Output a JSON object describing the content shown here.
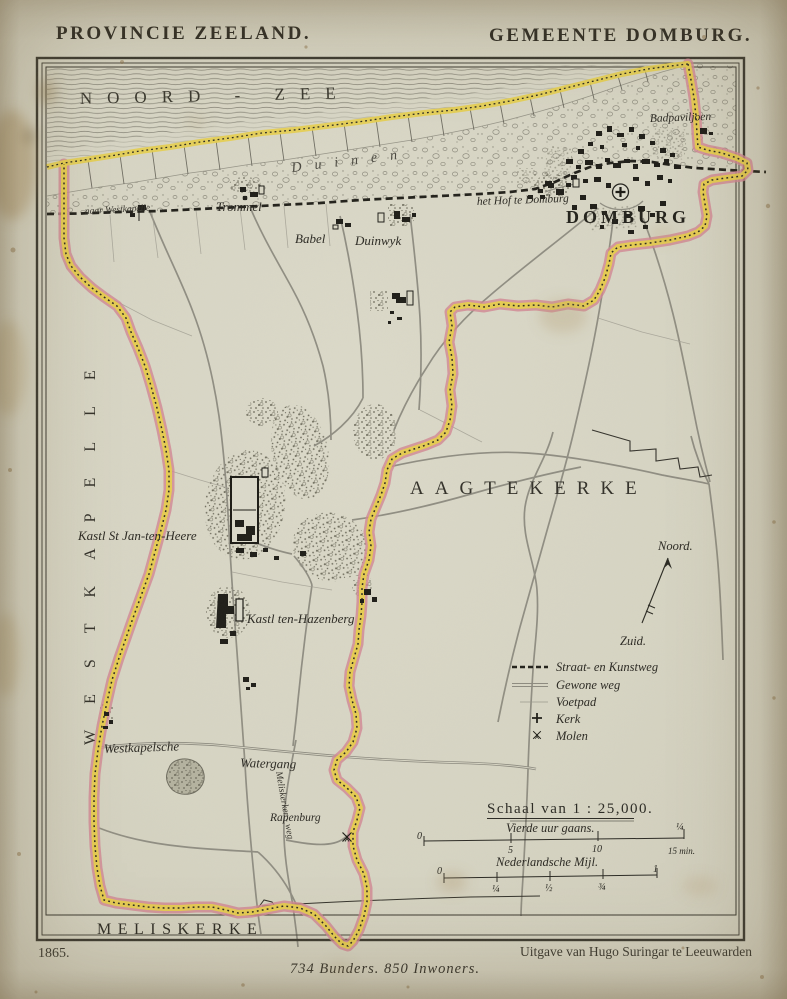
{
  "page": {
    "title_left": "PROVINCIE ZEELAND.",
    "title_right": "GEMEENTE DOMBURG.",
    "year": "1865.",
    "publisher": "Uitgave van Hugo Suringar te Leeuwarden",
    "statistics": "734 Bunders. 850 Inwoners."
  },
  "map": {
    "labels": {
      "sea": "NOORD - ZEE",
      "dunes": "Duinen",
      "town": "DOMBURG",
      "badpaviljoen": "Badpaviljoen",
      "het_hof": "het Hof te Domburg",
      "trommel": "Trommel",
      "babel": "Babel",
      "duinwyk": "Duinwyk",
      "naar_westkapelle": "naar Westkapelle",
      "westkapelle": "WESTKAPELLE",
      "aagtekerke": "AAGTEKERKE",
      "meliskerke": "MELISKERKE",
      "kasteel_st_jan": "Kastl St Jan-ten-Heere",
      "kasteel_hazenberg": "Kastl ten-Hazenberg",
      "watergang_line1": "Westkapelsche",
      "watergang_line2": "Watergang",
      "rapenburg": "Rapenburg",
      "meliskerker_weg": "Meliskerker - weg"
    },
    "compass": {
      "north": "Noord.",
      "south": "Zuid."
    },
    "legend": {
      "items": [
        {
          "label": "Straat- en Kunstweg"
        },
        {
          "label": "Gewone weg"
        },
        {
          "label": "Voetpad"
        },
        {
          "label": "Kerk"
        },
        {
          "label": "Molen"
        }
      ]
    },
    "scale": {
      "title": "Schaal van 1 : 25,000.",
      "bar1": {
        "label": "Vierde uur gaans.",
        "t0": "0",
        "t5": "5",
        "t10": "10",
        "tq": "¼",
        "tend": "15 min."
      },
      "bar2": {
        "label": "Nederlandsche Mijl.",
        "t0": "0",
        "t1": "¼",
        "t2": "½",
        "t3": "¾",
        "t4": "1"
      }
    },
    "colors": {
      "paper": "#d9d7c6",
      "ink": "#2b2a23",
      "boundary_yellow": "#e7cf4f",
      "boundary_pink": "#d28793",
      "road_gray": "#8d8b80"
    }
  }
}
